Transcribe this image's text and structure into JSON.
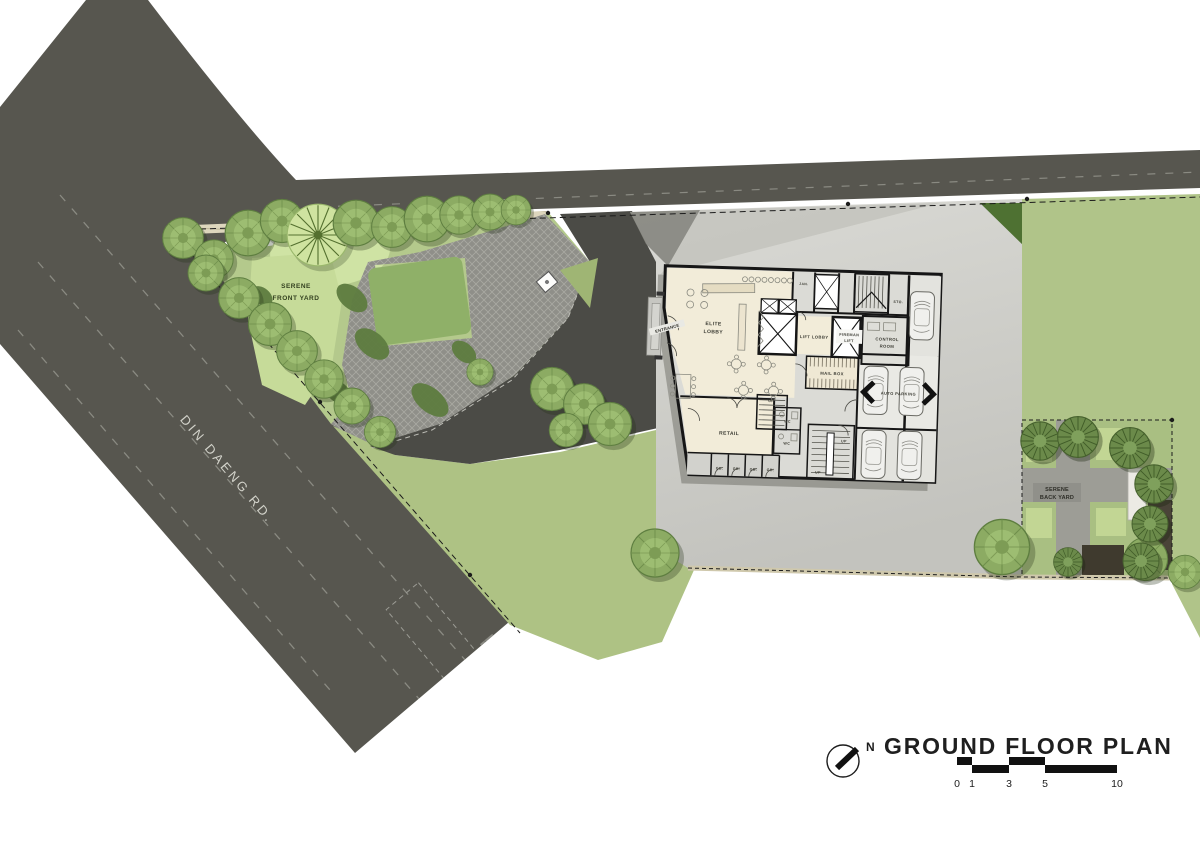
{
  "title_block": {
    "title": "GROUND FLOOR PLAN",
    "north_label": "N",
    "scale_ticks": [
      "0",
      "1",
      "3",
      "5",
      "10"
    ]
  },
  "site": {
    "road_name": "DIN DAENG RD.",
    "front_yard": {
      "line1": "SERENE",
      "line2": "FRONT YARD"
    },
    "back_yard": {
      "line1": "SERENE",
      "line2": "BACK YARD"
    }
  },
  "building": {
    "entrance": "ENTRANCE",
    "elite_lobby": {
      "line1": "ELITE",
      "line2": "LOBBY"
    },
    "lift_lobby": "LIFT LOBBY",
    "fireman_lift": {
      "line1": "FIREMAN",
      "line2": "LIFT"
    },
    "control_room": {
      "line1": "CONTROL",
      "line2": "ROOM"
    },
    "mail_box": "MAIL BOX",
    "retail": "RETAIL",
    "auto_parking": "AUTO PARKING",
    "wc": "WC",
    "jan": "JAN.",
    "sto": "STO.",
    "gb": "GB.",
    "up": "UP"
  },
  "colors": {
    "road": "#57564f",
    "driveway": "#4b4b46",
    "lawn": "#aec284",
    "lawn_bright": "#cfe3a4",
    "paving": "#cecec9",
    "floor_cream": "#f2ecd9",
    "dark_green": "#4e7132",
    "tree_green": "#8cab63",
    "ink": "#1c1c1c"
  }
}
